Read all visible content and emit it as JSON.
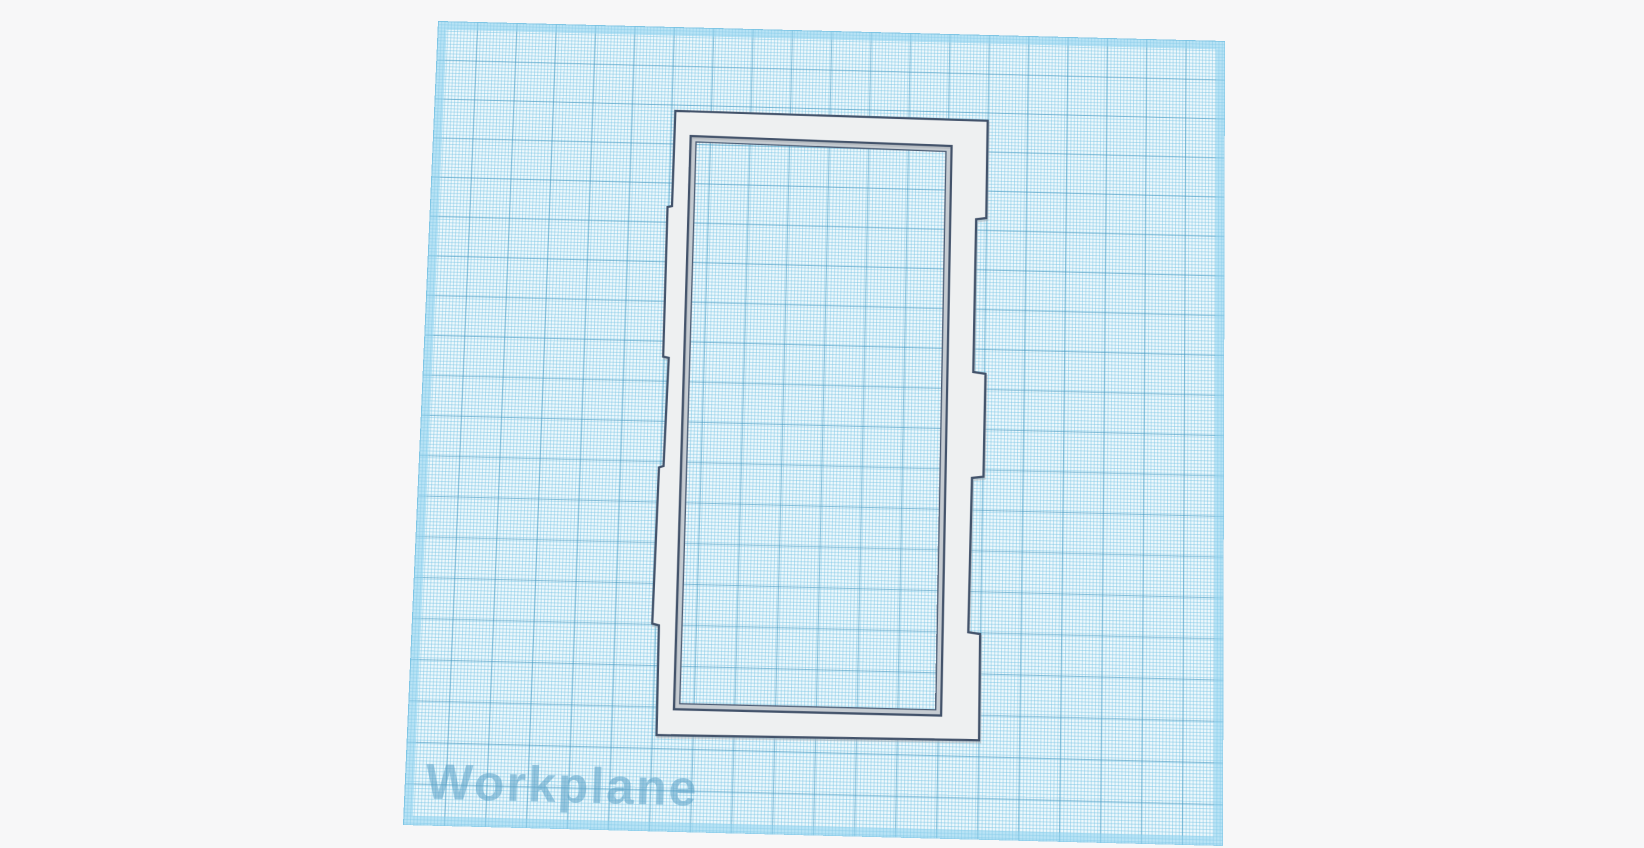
{
  "viewport": {
    "background_color": "#f7f7f8"
  },
  "workplane": {
    "label": "Workplane",
    "label_color": "rgba(88,158,196,0.55)",
    "fill_color": "#eef8fc",
    "minor_line_color": "rgba(121,196,228,0.50)",
    "major_line_color": "rgba(64,148,189,0.55)",
    "edge_highlight_color": "rgba(142,209,238,0.55)"
  },
  "model": {
    "face_color": "#eef0f1",
    "edge_color": "#42526a",
    "inner_wall_color": "#c6ccd2",
    "inner_wall_edge_color": "#4d5d75"
  }
}
